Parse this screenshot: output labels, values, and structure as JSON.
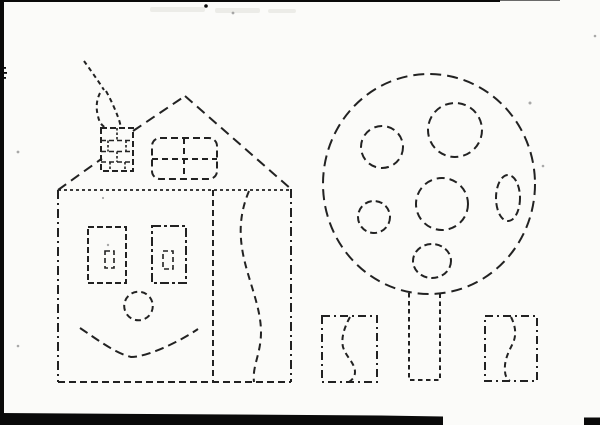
{
  "document": {
    "kind": "Scanned tracing worksheet page (dashed-outline drawing, no printed text)",
    "visible_text": []
  },
  "colors": {
    "paper": "#fbfbf9",
    "ink": "#222222",
    "scan_black": "#0a0a0a",
    "speck": "#8d8d8d",
    "bleedthrough": "#e9e9e4"
  },
  "scene": {
    "house": {
      "name": "house with smiling face",
      "parts": [
        "triangular roof",
        "brick chimney",
        "smoke curls",
        "four-pane rounded attic window",
        "two rectangular eye windows with small inner panes",
        "round nose circle",
        "smile curve",
        "right side panel with wavy S line"
      ]
    },
    "tree": {
      "name": "round fruit tree",
      "fruit_count": 6,
      "parts": [
        "large dashed circular crown",
        "five round fruits and one oval fruit",
        "rectangular trunk"
      ]
    },
    "bushes": {
      "name": "small rectangular bushes with wavy stem line",
      "count": 2
    },
    "scan_artifacts": [
      "black strip on left edge",
      "thin black line on top edge",
      "black bar along bottom edge",
      "dust specks"
    ]
  }
}
